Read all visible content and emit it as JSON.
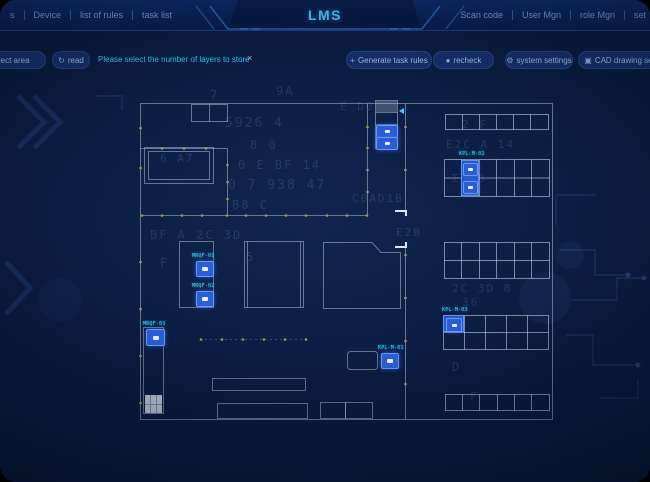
{
  "app": {
    "title": "LMS"
  },
  "topbar": {
    "left_fragment": "s",
    "left_items": [
      "Device",
      "list of rules",
      "task list"
    ],
    "right_items": [
      "Scan code",
      "User Mgn",
      "role Mgn",
      "set"
    ]
  },
  "toolbar": {
    "select_area": "select area",
    "read": "read",
    "read_icon": "↻",
    "message": "Please select the number of layers to store",
    "message_close": "×",
    "buttons": [
      {
        "icon": "+",
        "label": "Generate task rules"
      },
      {
        "icon": "●",
        "label": "recheck"
      },
      {
        "icon": "⚙",
        "label": "system settings"
      },
      {
        "icon": "▣",
        "label": "CAD drawing settings"
      }
    ]
  },
  "plan": {
    "markers": [
      {
        "label": "MRQF-01"
      },
      {
        "label": "MRQF-02"
      },
      {
        "label": "MRQF-03"
      },
      {
        "label": "KPL-M-01"
      },
      {
        "label": "KPL-M-02"
      },
      {
        "label": "KPL-M-03"
      }
    ]
  },
  "colors": {
    "accent_cyan": "#37d3f3",
    "marker_blue": "#2b5ed6",
    "title_cyan": "#4cc0ee",
    "wall_line": "#becbdf",
    "column_dot": "#ab9153"
  },
  "decor": {
    "matrix": [
      {
        "t": "9A",
        "x": 276,
        "y": 84,
        "s": 12
      },
      {
        "t": "7",
        "x": 210,
        "y": 88,
        "s": 12
      },
      {
        "t": "E D0",
        "x": 340,
        "y": 100,
        "s": 11
      },
      {
        "t": "5926 4",
        "x": 225,
        "y": 116,
        "s": 13
      },
      {
        "t": "2 F",
        "x": 462,
        "y": 118,
        "s": 11
      },
      {
        "t": "8 0",
        "x": 250,
        "y": 138,
        "s": 12
      },
      {
        "t": "E2C A 14",
        "x": 446,
        "y": 138,
        "s": 11
      },
      {
        "t": "6 A7",
        "x": 160,
        "y": 152,
        "s": 11
      },
      {
        "t": "0 E BF 14",
        "x": 238,
        "y": 158,
        "s": 12
      },
      {
        "t": "Σ C8",
        "x": 452,
        "y": 172,
        "s": 11
      },
      {
        "t": "0 7 938 47",
        "x": 228,
        "y": 178,
        "s": 13
      },
      {
        "t": "B8 C",
        "x": 232,
        "y": 198,
        "s": 12
      },
      {
        "t": "C0AD1B",
        "x": 352,
        "y": 192,
        "s": 11
      },
      {
        "t": "BF A 2C 3D",
        "x": 150,
        "y": 228,
        "s": 12
      },
      {
        "t": "E2B",
        "x": 396,
        "y": 226,
        "s": 11
      },
      {
        "t": "5",
        "x": 246,
        "y": 250,
        "s": 12
      },
      {
        "t": "F",
        "x": 160,
        "y": 256,
        "s": 12
      },
      {
        "t": "2C 3D 8",
        "x": 452,
        "y": 282,
        "s": 11
      },
      {
        "t": "36",
        "x": 462,
        "y": 296,
        "s": 11
      },
      {
        "t": "D",
        "x": 452,
        "y": 360,
        "s": 12
      },
      {
        "t": "F",
        "x": 470,
        "y": 390,
        "s": 12
      }
    ]
  }
}
